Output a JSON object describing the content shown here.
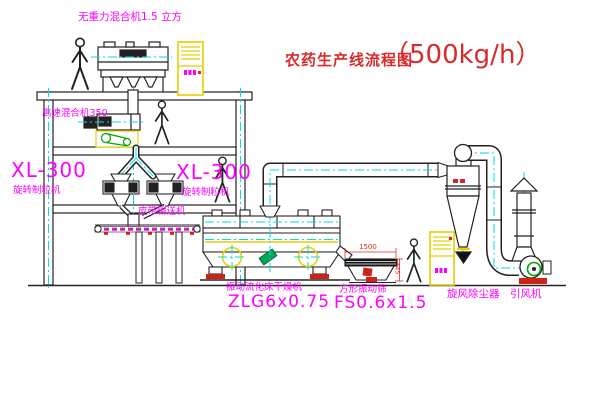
{
  "title": {
    "main": "农药生产线流程图",
    "capacity": "（500kg/h）"
  },
  "labels": {
    "gravity_mixer": "无重力混合机1.5 立方",
    "speed_mixer": "高速混合机350",
    "granulator_left_model": "XL-300",
    "granulator_left_name": "旋转制粒机",
    "granulator_right_model": "XL-300",
    "granulator_right_name": "旋转制粒机",
    "belt_conveyor": "皮带输送机",
    "dryer_name": "振动流化床干燥机",
    "dryer_model": "ZLG6x0.75",
    "screen_name": "方形振动筛",
    "screen_model": "FS0.6x1.5",
    "cyclone": "旋风除尘器",
    "fan": "引风机"
  },
  "dimensions": {
    "screen_width": "1500",
    "screen_height": "345"
  },
  "colors": {
    "line": "#222222",
    "centerline_cyan": "#00dede",
    "equipment_yellow": "#e8cf00",
    "label_magenta": "#ff00ff",
    "title_red": "#d92b2b",
    "accent_red": "#cc2418",
    "fan_green": "#00a400"
  }
}
